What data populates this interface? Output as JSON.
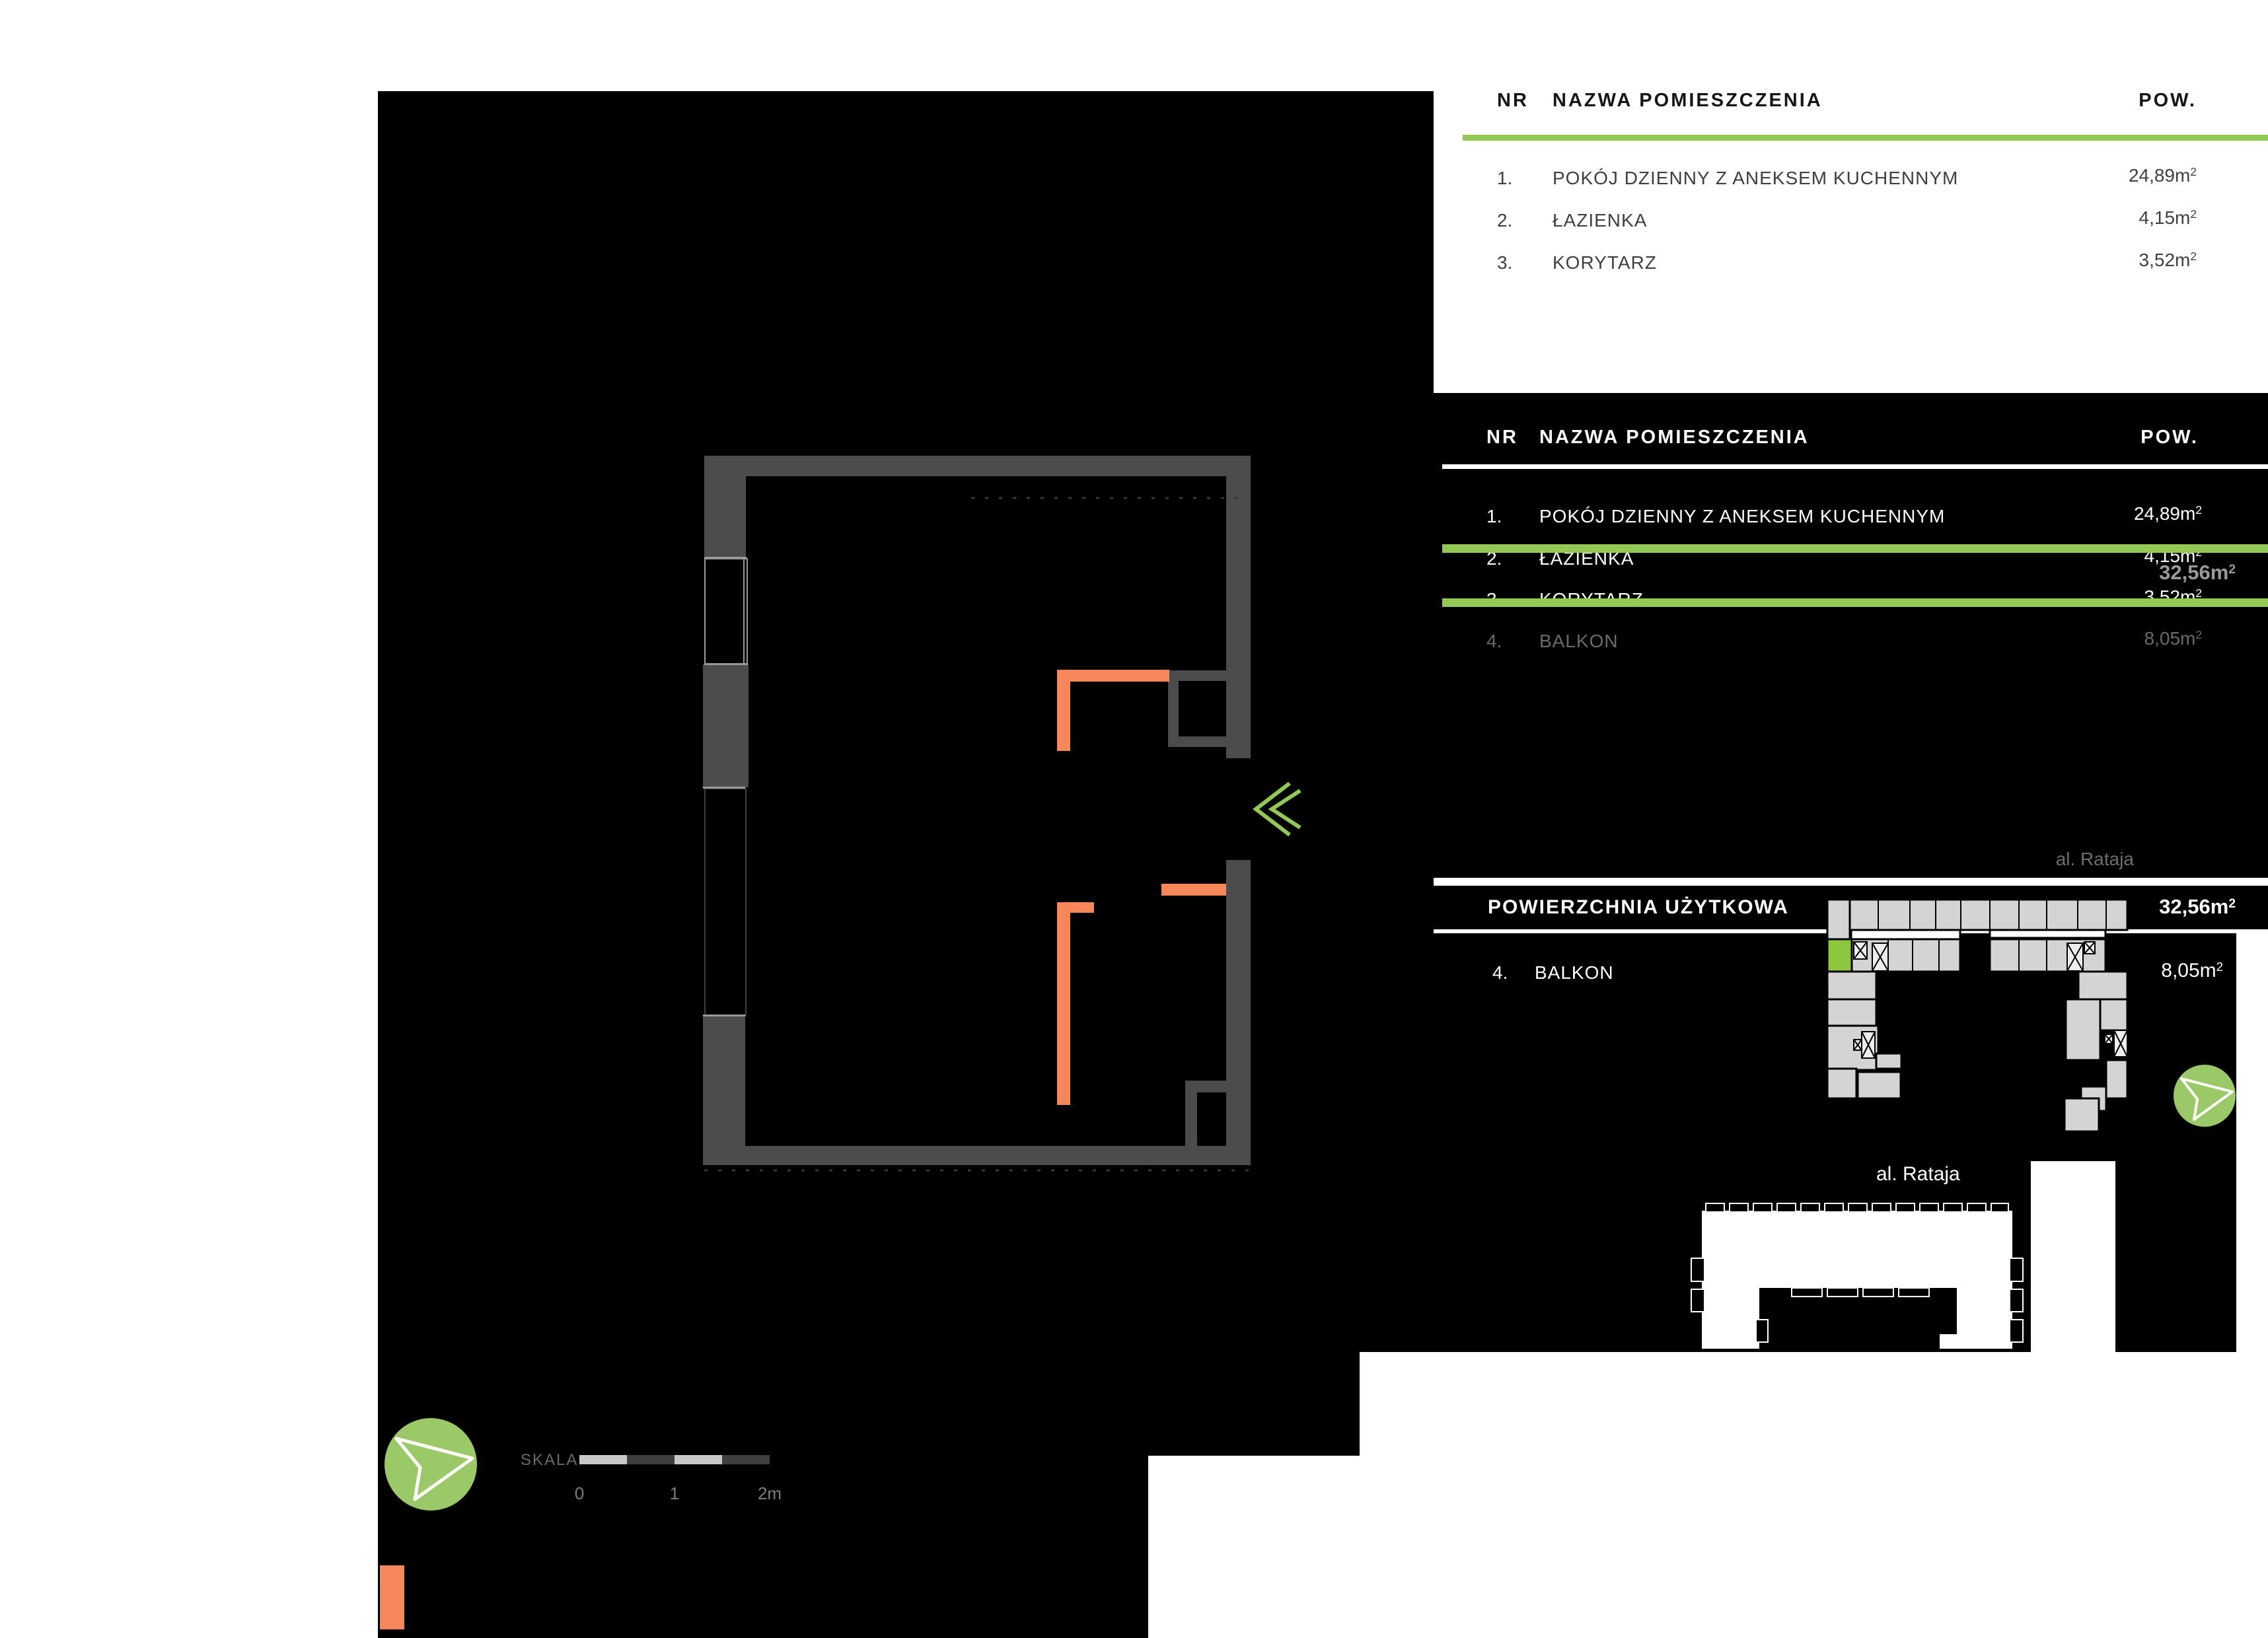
{
  "table1": {
    "header": {
      "nr": "NR",
      "name": "NAZWA POMIESZCZENIA",
      "area": "POW."
    },
    "rows": [
      {
        "nr": "1.",
        "name": "POKÓJ DZIENNY Z ANEKSEM KUCHENNYM",
        "area": "24,89m",
        "sup": "2"
      },
      {
        "nr": "2.",
        "name": "ŁAZIENKA",
        "area": "4,15m",
        "sup": "2"
      },
      {
        "nr": "3.",
        "name": "KORYTARZ",
        "area": "3,52m",
        "sup": "2"
      }
    ]
  },
  "table2": {
    "header": {
      "nr": "NR",
      "name": "NAZWA POMIESZCZENIA",
      "area": "POW."
    },
    "rows": [
      {
        "nr": "1.",
        "name": "POKÓJ DZIENNY Z ANEKSEM KUCHENNYM",
        "area": "24,89m",
        "sup": "2"
      },
      {
        "nr": "2.",
        "name": "ŁAZIENKA",
        "area": "4,15m",
        "sup": "2"
      },
      {
        "nr": "3.",
        "name": "KORYTARZ",
        "area": "3,52m",
        "sup": "2"
      },
      {
        "nr": "4.",
        "name": "BALKON",
        "area": "8,05m",
        "sup": "2"
      }
    ],
    "hover_total": {
      "area": "32,56m",
      "sup": "2"
    }
  },
  "usable_area": {
    "label": "POWIERZCHNIA UŻYTKOWA",
    "area": "32,56m",
    "sup": "2"
  },
  "balcony_row": {
    "nr": "4.",
    "name": "BALKON",
    "area": "8,05m",
    "sup": "2"
  },
  "streets": {
    "top": "al. Rataja",
    "bottom": "al. Rataja"
  },
  "scalebar": {
    "label": "SKALA",
    "ticks": [
      "0",
      "1",
      "2m"
    ]
  },
  "icons": {
    "entrance": "double-chevron-left-icon",
    "north_small": "compass-arrow-icon",
    "north_large": "compass-arrow-icon"
  },
  "colors": {
    "accent_green": "#92c853",
    "unit_green": "#8dc63f",
    "compass_green": "#9bc968",
    "wall_gray": "#4c4c4c",
    "highlight_orange": "#f5875a",
    "building_gray": "#d4d4d4"
  }
}
